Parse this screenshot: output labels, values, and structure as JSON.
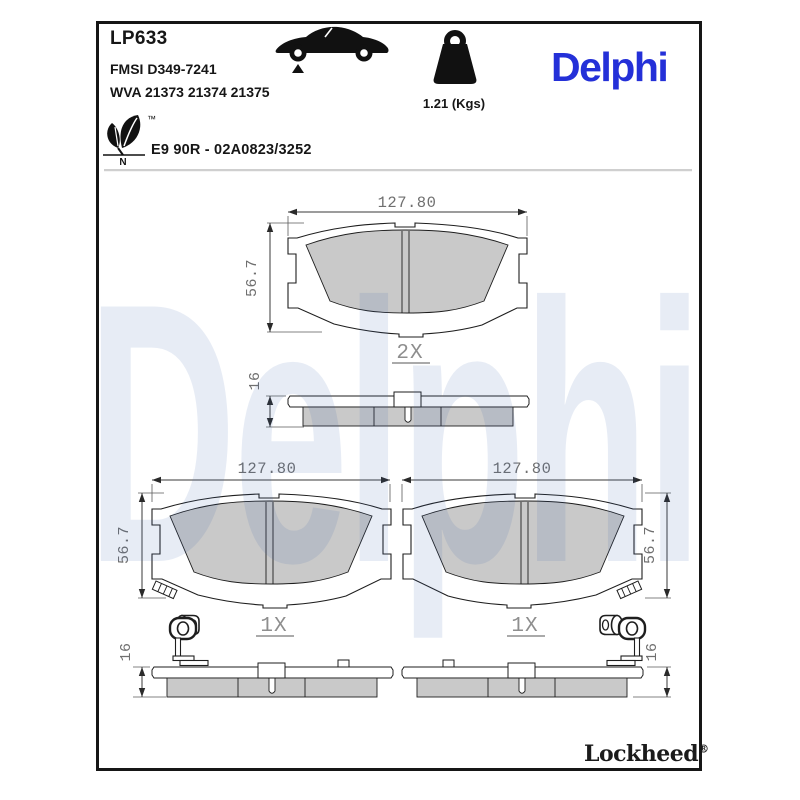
{
  "header": {
    "part_number": "LP633",
    "fmsi_ref": "FMSI D349-7241",
    "wva_ref": "WVA 21373 21374 21375",
    "weight_label": "1.21 (Kgs)",
    "brand_logo": "Delphi",
    "approval_code": "E9 90R - 02A0823/3252",
    "eco_leaf_letter": "N",
    "trademark_symbol": "™"
  },
  "footer": {
    "brand": "Lockheed",
    "registered_symbol": "®"
  },
  "watermark_text": "Delphi",
  "drawings": {
    "front_view_top": {
      "width_mm": "127.80",
      "height_mm": "56.7",
      "quantity": "2X"
    },
    "side_view_top": {
      "thickness_mm": "16"
    },
    "front_view_left": {
      "width_mm": "127.80",
      "height_mm": "56.7",
      "quantity": "1X"
    },
    "front_view_right": {
      "width_mm": "127.80",
      "height_mm": "56.7",
      "quantity": "1X"
    },
    "side_view_left": {
      "thickness_mm": "16"
    },
    "side_view_right": {
      "thickness_mm": "16"
    }
  },
  "colors": {
    "brand_blue": "#2430d8",
    "friction_gray": "#c9c9c9",
    "dimension_gray": "#6f6f6f",
    "outline_black": "#1e1e1e",
    "watermark_tint": "rgba(58,100,175,0.12)"
  }
}
